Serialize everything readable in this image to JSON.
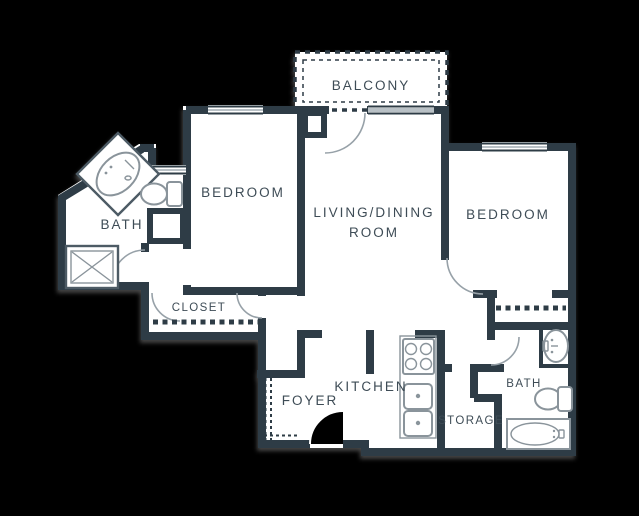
{
  "floor_plan": {
    "rooms": {
      "balcony": {
        "label": "BALCONY"
      },
      "bedroom_left": {
        "label": "BEDROOM"
      },
      "living_dining": {
        "label_line1": "LIVING/DINING",
        "label_line2": "ROOM"
      },
      "bedroom_right": {
        "label": "BEDROOM"
      },
      "bath_left": {
        "label": "BATH"
      },
      "closet": {
        "label": "CLOSET"
      },
      "kitchen": {
        "label": "KITCHEN"
      },
      "foyer": {
        "label": "FOYER"
      },
      "storage": {
        "label": "STORAGE"
      },
      "bath_right": {
        "label": "BATH"
      }
    },
    "fixtures": {
      "left_bath": [
        "vanity-sink",
        "toilet",
        "shower"
      ],
      "right_bath": [
        "vanity-sink",
        "toilet",
        "bathtub"
      ],
      "kitchen": [
        "stove",
        "double-sink",
        "counter"
      ]
    },
    "colors": {
      "background": "#000000",
      "floor": "#ffffff",
      "wall": "#2e3c46",
      "label_text": "#3e4c56",
      "fixture_outline": "#8a949b",
      "door_arc": "#97a1a8"
    }
  }
}
